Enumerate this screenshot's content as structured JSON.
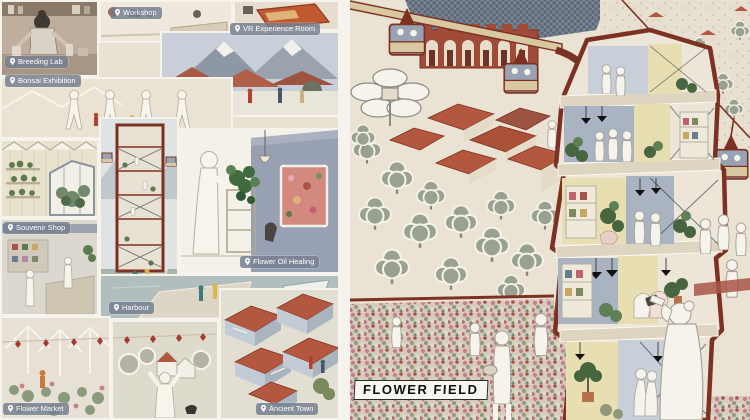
{
  "title": "FLOWER FIELD",
  "labels": {
    "breeding_lab": "Breeding Lab",
    "workshop": "Workshop",
    "vr_experience_room": "VR Experience Room",
    "bonsai_exhibition": "Bonsai Exhibition",
    "souvenir_shop": "Souvenir Shop",
    "flower_oil_healing": "Flower Oil Healing",
    "harbour": "Harbour",
    "flower_market": "Flower Market",
    "ancient_town": "Ancient Town"
  },
  "palette": {
    "maroon_outline": "#7d3122",
    "roof_red": "#b3573e",
    "brick_red": "#a04a38",
    "slate_wall": "#a9b3c1",
    "dark_slate": "#5d6878",
    "pale_yellow": "#e7dfb2",
    "cream": "#ece5d8",
    "tree_gray_green": "#99a191",
    "label_chip_bg": "#768090",
    "flower_pink": "#c8808c"
  }
}
